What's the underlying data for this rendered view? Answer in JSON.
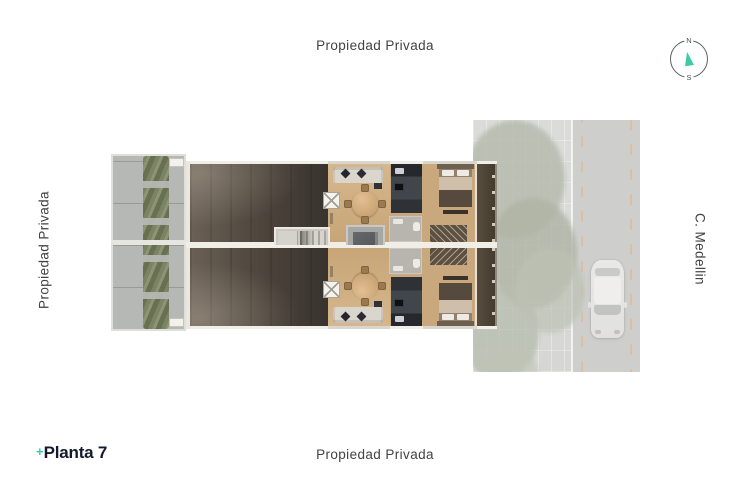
{
  "labels": {
    "top": "Propiedad Privada",
    "bottom": "Propiedad Privada",
    "left": "Propiedad Privada",
    "right": "C. Medellin"
  },
  "compass": {
    "north": "N",
    "south": "S",
    "needle_color": "#3dcaa6",
    "ring_color": "#5a6066"
  },
  "logo": {
    "plus": "+",
    "name": "Planta 7",
    "plus_color": "#2fd0ac",
    "text_color": "#121a2b"
  },
  "plan": {
    "palette": {
      "roof_deck": "#4a423a",
      "wood_floor": "#caa87d",
      "terrace": "#b5b8b4",
      "hedge": "#737c5d",
      "street": "#b9bab6",
      "road_marking": "#cc9254",
      "balcony": "#4c4337",
      "wall": "#f1eee8",
      "stair_core": "#cbc8c1",
      "kitchen_counter": "#2e3136",
      "bed_blanket": "#564a3e"
    }
  }
}
